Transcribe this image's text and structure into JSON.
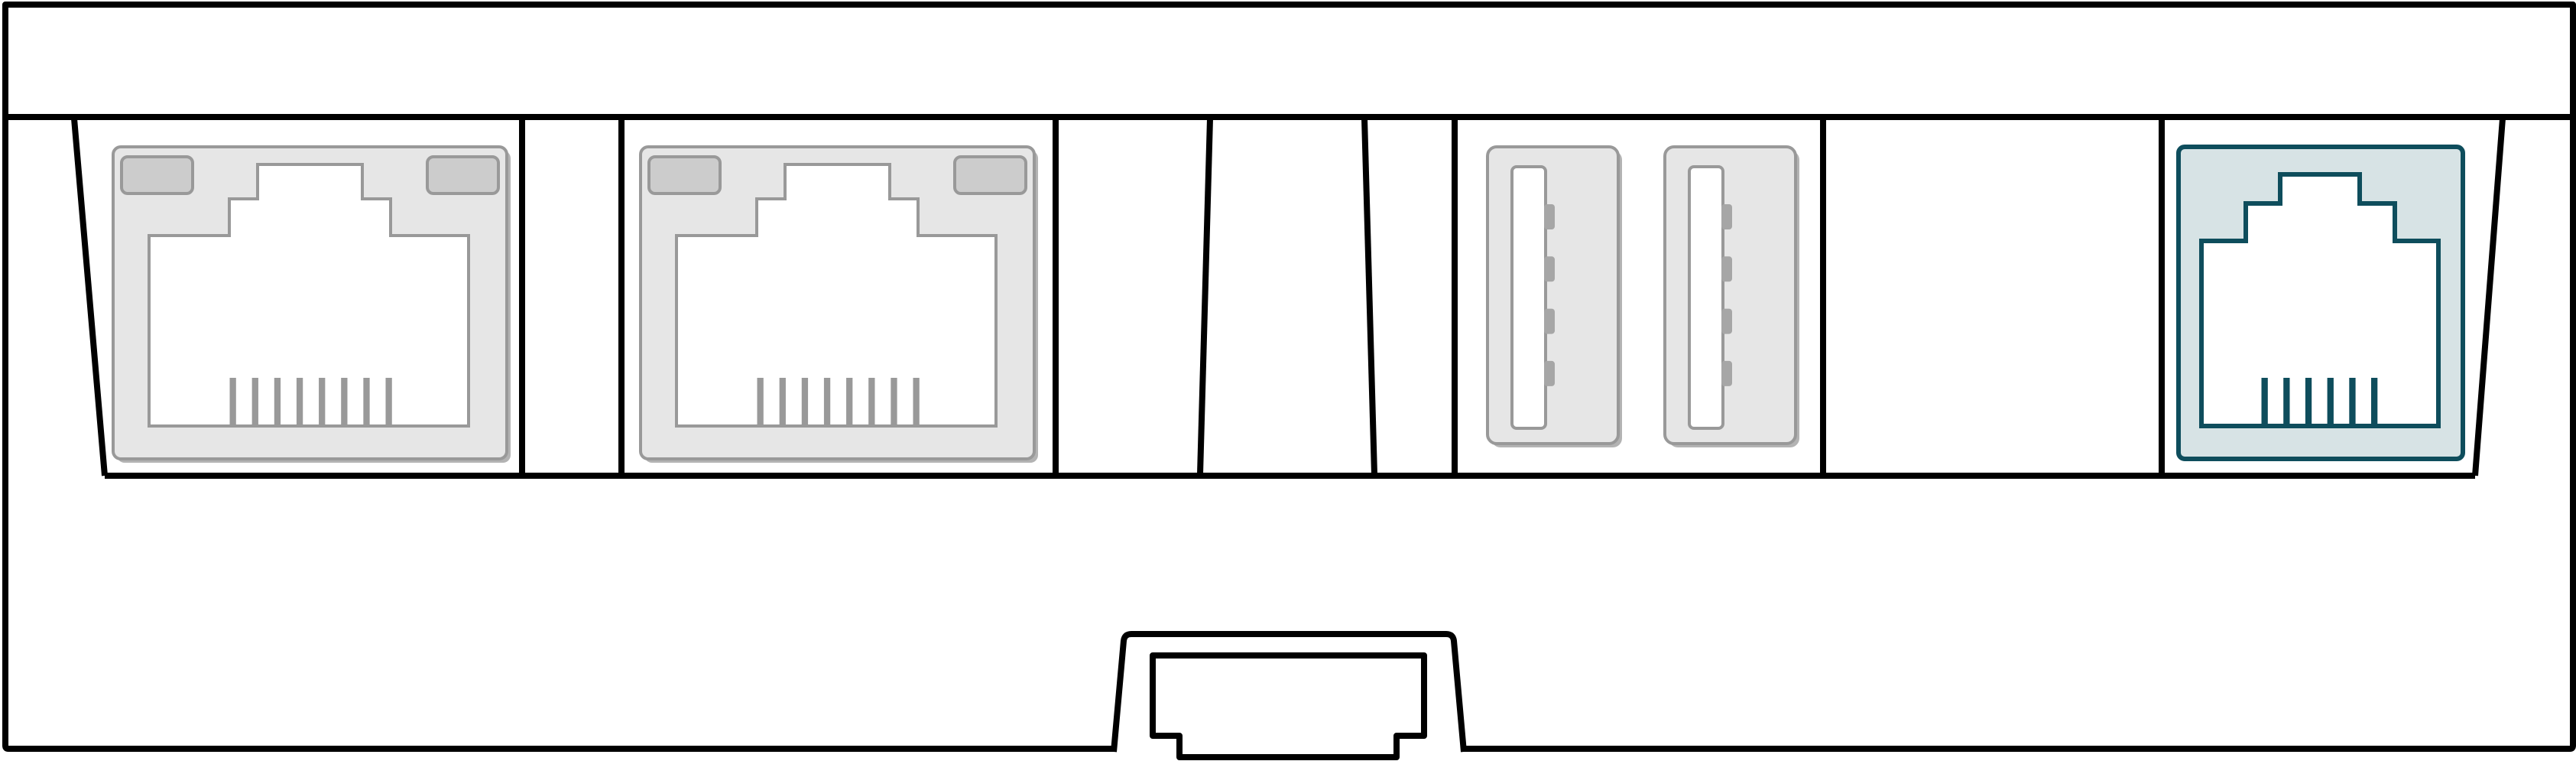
{
  "diagram": {
    "description": "Rear panel line diagram of a network device: two RJ45 Ethernet ports, one empty slot, two USB-A ports, one highlighted RJ45 console port, and a bottom expansion connector",
    "device": "network-device-rear-panel"
  },
  "colors": {
    "background": "#ffffff",
    "outline": "#000000",
    "port_bezel": "#e6e6e6",
    "port_border": "#999999",
    "tab_fill": "#cccccc",
    "pin": "#999999",
    "usb_contact": "#a6a6a6",
    "console_fill": "#d7e3e5",
    "console_border": "#0e4d5c",
    "shadow": "#b3b3b3"
  },
  "ports": [
    {
      "id": "ethernet-1",
      "type": "rj45-ethernet-port",
      "pins": 8,
      "highlighted": false
    },
    {
      "id": "ethernet-2",
      "type": "rj45-ethernet-port",
      "pins": 8,
      "highlighted": false
    },
    {
      "id": "empty-slot",
      "type": "empty-slot",
      "pins": 0,
      "highlighted": false
    },
    {
      "id": "usb-1",
      "type": "usb-a-port",
      "pins": 4,
      "highlighted": false
    },
    {
      "id": "usb-2",
      "type": "usb-a-port",
      "pins": 4,
      "highlighted": false
    },
    {
      "id": "console",
      "type": "rj45-console-port",
      "pins": 6,
      "highlighted": true
    }
  ],
  "connector": {
    "id": "expansion-connector",
    "type": "bottom-expansion-connector",
    "position": "bottom-center"
  }
}
